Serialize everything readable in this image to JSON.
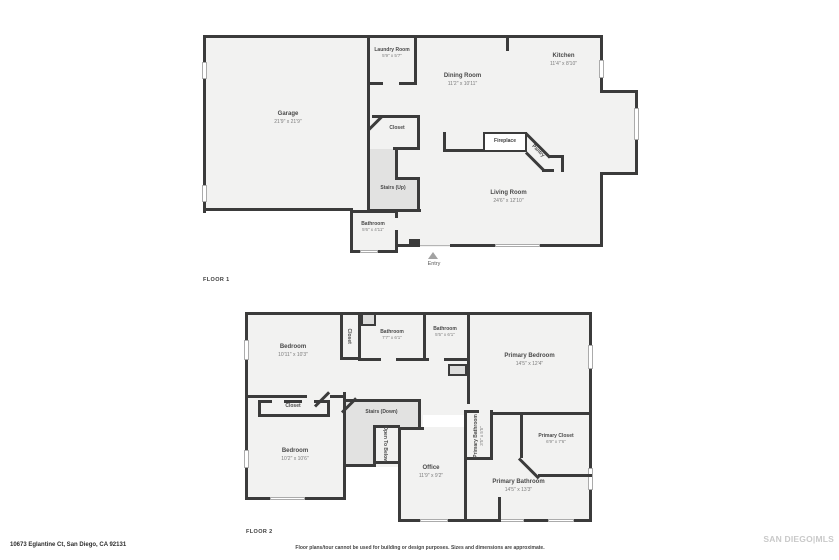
{
  "page": {
    "address": "10673 Eglantine Ct, San Diego, CA 92131",
    "disclaimer": "Floor plans/tour cannot be used for building or design purposes. Sizes and dimensions are approximate.",
    "watermark": "SAN DIEGO|MLS"
  },
  "floor1": {
    "label": "FLOOR 1",
    "entry_label": "Entry",
    "rooms": {
      "garage": {
        "name": "Garage",
        "dims": "21'9\" x 21'9\""
      },
      "laundry": {
        "name": "Laundry Room",
        "dims": "5'9\" x 5'7\""
      },
      "dining": {
        "name": "Dining Room",
        "dims": "11'2\" x 10'11\""
      },
      "kitchen": {
        "name": "Kitchen",
        "dims": "11'4\" x 8'10\""
      },
      "closet": {
        "name": "Closet"
      },
      "stairs": {
        "name": "Stairs (Up)"
      },
      "bathroom": {
        "name": "Bathroom",
        "dims": "5'6\" x 4'11\""
      },
      "living": {
        "name": "Living Room",
        "dims": "24'6\" x 12'10\""
      },
      "fireplace": {
        "name": "Fireplace"
      },
      "pantry": {
        "name": "Pantry"
      }
    }
  },
  "floor2": {
    "label": "FLOOR 2",
    "rooms": {
      "bedroom_tl": {
        "name": "Bedroom",
        "dims": "10'11\" x 10'3\""
      },
      "closet_tl": {
        "name": "Closet"
      },
      "bathroom1": {
        "name": "Bathroom",
        "dims": "7'7\" x 6'1\""
      },
      "bathroom2": {
        "name": "Bathroom",
        "dims": "5'5\" x 6'1\""
      },
      "primary_bedroom": {
        "name": "Primary Bedroom",
        "dims": "14'5\" x 12'4\""
      },
      "closet_left": {
        "name": "Closet"
      },
      "stairs": {
        "name": "Stairs (Down)"
      },
      "open_below": {
        "name": "Open To Below"
      },
      "bedroom_bl": {
        "name": "Bedroom",
        "dims": "10'2\" x 10'6\""
      },
      "office": {
        "name": "Office",
        "dims": "11'9\" x 9'2\""
      },
      "primary_bath_small": {
        "name": "Primary Bathroom",
        "dims": "3'5\" x 5'5\""
      },
      "primary_closet": {
        "name": "Primary Closet",
        "dims": "6'9\" x 7'6\""
      },
      "primary_bath": {
        "name": "Primary Bathroom",
        "dims": "14'5\" x 13'3\""
      }
    }
  }
}
